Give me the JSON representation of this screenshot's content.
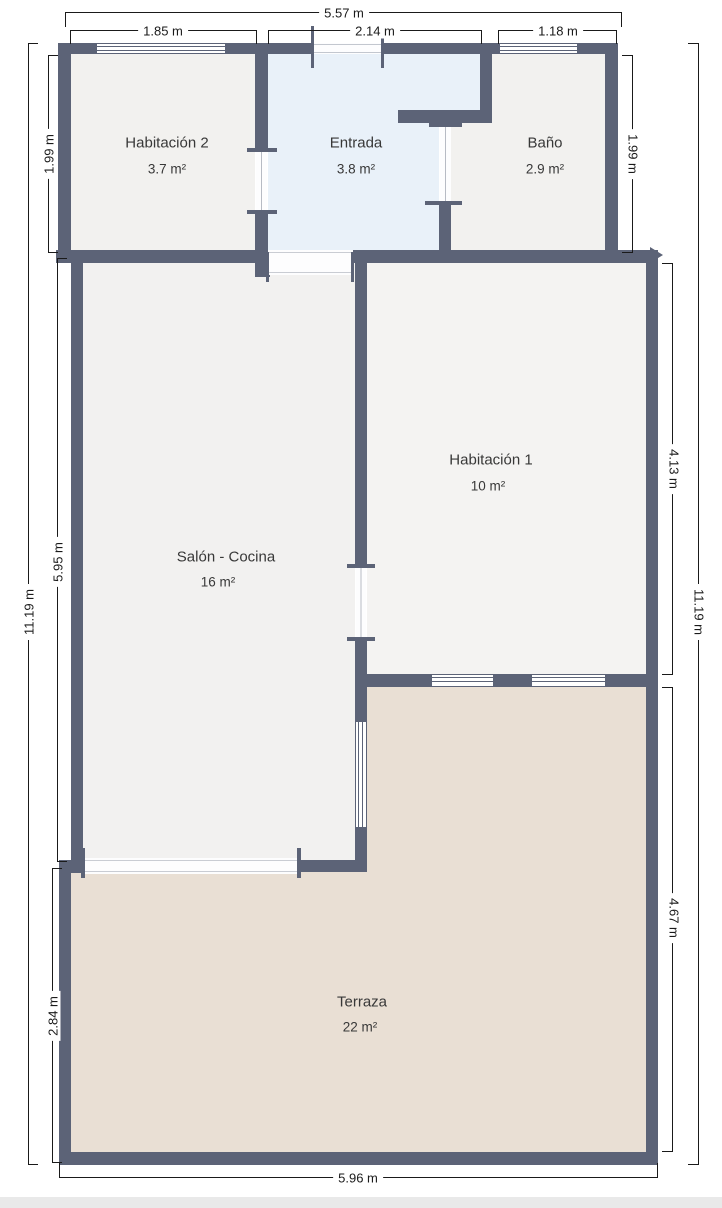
{
  "title": "Floor plan",
  "rooms": {
    "hab2": {
      "name": "Habitación 2",
      "area": "3.7 m²"
    },
    "entrada": {
      "name": "Entrada",
      "area": "3.8 m²"
    },
    "bano": {
      "name": "Baño",
      "area": "2.9 m²"
    },
    "hab1": {
      "name": "Habitación 1",
      "area": "10 m²"
    },
    "salon": {
      "name": "Salón - Cocina",
      "area": "16 m²"
    },
    "terraza": {
      "name": "Terraza",
      "area": "22 m²"
    }
  },
  "dimensions": {
    "top_total": "5.57 m",
    "top_hab2": "1.85 m",
    "top_entrada": "2.14 m",
    "top_bano": "1.18 m",
    "left_total": "11.19 m",
    "left_top": "1.99 m",
    "left_middle": "5.95 m",
    "left_bottom": "2.84 m",
    "right_total": "11.19 m",
    "right_top": "1.99 m",
    "right_hab1": "4.13 m",
    "right_terraza": "4.67 m",
    "bottom_total": "5.96 m"
  },
  "colors": {
    "wall": "#5c6377",
    "dim_line": "#1a1a1a",
    "text": "#383838",
    "floor_default": "#f2f1ef",
    "floor_entrada": "#e9f1f9",
    "floor_hab1": "#f4f3f2",
    "floor_salon": "#f2f1f0",
    "floor_terraza": "#e9dfd4",
    "footer_strip": "#e9e9e9"
  }
}
